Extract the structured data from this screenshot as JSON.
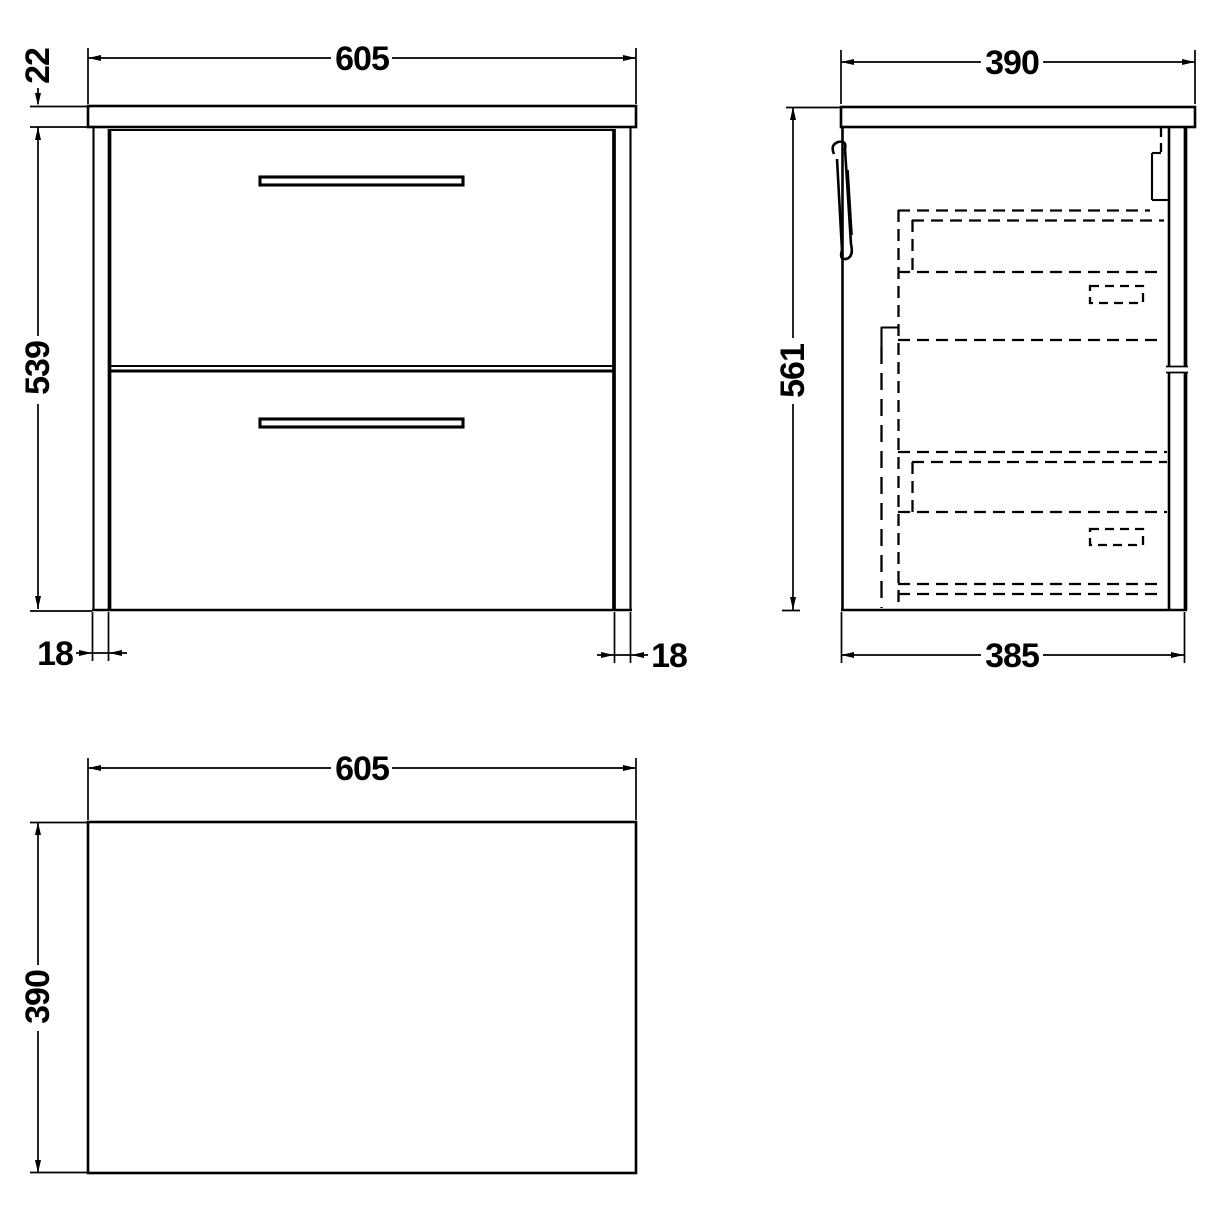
{
  "front_view": {
    "width_label": "605",
    "worktop_thickness_label": "22",
    "height_label": "539",
    "left_panel_thickness_label": "18",
    "right_panel_thickness_label": "18"
  },
  "side_view": {
    "depth_label": "390",
    "height_label": "561",
    "bottom_depth_label": "385"
  },
  "plan_view": {
    "width_label": "605",
    "depth_label": "390"
  },
  "colors": {
    "line": "#000000",
    "background": "#ffffff"
  }
}
